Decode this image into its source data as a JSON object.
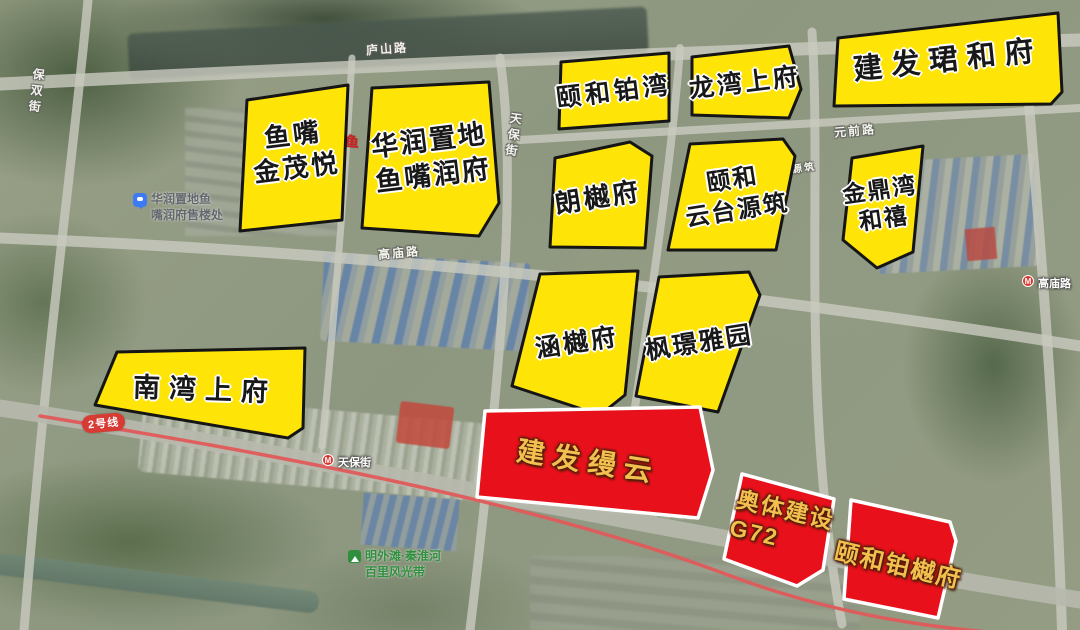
{
  "map": {
    "colors": {
      "plot_yellow": "#FFE408",
      "plot_red": "#E8101B",
      "plot_border": "#151515",
      "plot_border_red": "#FFFFFF",
      "gold_text": "#F3C04F",
      "metro_line2": "#E05A5A",
      "street_text": "#FAFAF2",
      "park_green": "#2F8F3F",
      "poi_gray": "#63676D",
      "pin_blue": "#3D7BF5",
      "fragment_red": "#CC2222"
    },
    "streets": [
      {
        "id": "baoshuang-st",
        "label": "保双街",
        "x": 28,
        "y": 68,
        "vertical": true,
        "rot": 7,
        "size": 12
      },
      {
        "id": "lushan-rd",
        "label": "庐山路",
        "x": 366,
        "y": 40,
        "vertical": false,
        "rot": -4,
        "size": 12
      },
      {
        "id": "yuanqian-rd",
        "label": "元前路",
        "x": 834,
        "y": 122,
        "vertical": false,
        "rot": -5,
        "size": 12
      },
      {
        "id": "tianbao-st-v",
        "label": "天保街",
        "x": 505,
        "y": 112,
        "vertical": true,
        "rot": 8,
        "size": 12
      },
      {
        "id": "gaomiao-rd",
        "label": "高庙路",
        "x": 378,
        "y": 244,
        "vertical": false,
        "rot": -5,
        "size": 12
      },
      {
        "id": "taiyuanzhu",
        "label": "台源筑",
        "x": 780,
        "y": 160,
        "vertical": false,
        "rot": -8,
        "size": 10
      }
    ],
    "pois": {
      "sales_office": {
        "lines": [
          "华润置地鱼",
          "嘴润府售楼处"
        ]
      },
      "park": {
        "lines": [
          "明外滩·秦淮河",
          "百里风光带"
        ]
      },
      "metro_tianbao": {
        "label": "天保街"
      },
      "metro_gaomiao": {
        "label": "高庙路"
      },
      "line2": {
        "label": "2号线"
      },
      "red_fragment": {
        "label": "国鱼"
      }
    },
    "plots": [
      {
        "id": "yuzui-jinmaoyue",
        "type": "yellow",
        "points": "247,100 348,85 342,220 240,231",
        "label_lines": [
          "鱼嘴",
          "金茂悦"
        ],
        "lx": 295,
        "ly": 152,
        "rot": -7,
        "size": 26,
        "ls": 3
      },
      {
        "id": "huarun-runfu",
        "type": "yellow",
        "points": "372,88 489,82 499,203 479,236 362,228",
        "label_lines": [
          "华润置地",
          "鱼嘴润府"
        ],
        "lx": 431,
        "ly": 158,
        "rot": -7,
        "size": 27,
        "ls": 2
      },
      {
        "id": "yihe-bowan",
        "type": "yellow",
        "points": "561,62 669,53 669,121 559,129",
        "label_lines": [
          "颐和铂湾"
        ],
        "lx": 614,
        "ly": 92,
        "rot": -7,
        "size": 25,
        "ls": 4
      },
      {
        "id": "longwan-shangfu",
        "type": "yellow",
        "points": "692,57 789,46 801,89 789,118 692,115",
        "label_lines": [
          "龙湾上府"
        ],
        "lx": 745,
        "ly": 83,
        "rot": -7,
        "size": 25,
        "ls": 3
      },
      {
        "id": "jianfa-junhefu",
        "type": "yellow",
        "points": "838,38 1058,13 1062,92 1051,104 834,106",
        "label_lines": [
          "建发珺和府"
        ],
        "lx": 948,
        "ly": 61,
        "rot": -6,
        "size": 29,
        "ls": 9
      },
      {
        "id": "langyuefu",
        "type": "yellow",
        "points": "555,158 630,142 652,156 645,248 550,247",
        "label_lines": [
          "朗樾府"
        ],
        "lx": 598,
        "ly": 198,
        "rot": -9,
        "size": 26,
        "ls": 3
      },
      {
        "id": "yihe-yuntaiyuanzhu",
        "type": "yellow",
        "points": "690,144 783,139 795,156 776,250 668,250",
        "label_lines": [
          "颐和",
          "云台源筑"
        ],
        "lx": 735,
        "ly": 196,
        "rot": -9,
        "size": 24,
        "ls": 2
      },
      {
        "id": "jindingwan-hexi",
        "type": "yellow",
        "points": "852,158 923,146 913,252 877,268 843,240",
        "label_lines": [
          "金鼎湾",
          "和禧"
        ],
        "lx": 882,
        "ly": 205,
        "rot": -8,
        "size": 23,
        "ls": 2
      },
      {
        "id": "hanyuefu",
        "type": "yellow",
        "points": "540,274 638,271 625,395 600,415 512,386",
        "label_lines": [
          "涵樾府"
        ],
        "lx": 577,
        "ly": 343,
        "rot": -9,
        "size": 25,
        "ls": 3
      },
      {
        "id": "fengjing-yayuan",
        "type": "yellow",
        "points": "659,277 749,272 760,295 718,412 636,396",
        "label_lines": [
          "枫璟雅园"
        ],
        "lx": 699,
        "ly": 343,
        "rot": -9,
        "size": 25,
        "ls": 2
      },
      {
        "id": "nanwan-shangfu",
        "type": "yellow",
        "points": "117,352 305,348 303,428 288,438 95,405",
        "label_lines": [
          "南湾上府"
        ],
        "lx": 205,
        "ly": 390,
        "rot": 2,
        "size": 27,
        "ls": 9
      },
      {
        "id": "jianfa-manyun",
        "type": "red",
        "points": "485,411 700,407 713,470 698,518 477,497",
        "label_lines": [
          "建发缦云"
        ],
        "lx": 588,
        "ly": 462,
        "rot": 9,
        "size": 28,
        "ls": 8
      },
      {
        "id": "aoti-g72",
        "type": "red",
        "points": "742,474 834,499 823,570 797,586 724,559",
        "label_lines": [
          "奥体建设",
          "G72"
        ],
        "lx": 782,
        "ly": 525,
        "rot": 13,
        "size": 23,
        "ls": 2,
        "align": "left"
      },
      {
        "id": "yihe-boyuefu",
        "type": "red",
        "points": "851,500 950,522 956,541 938,618 844,599",
        "label_lines": [
          "颐和铂樾府"
        ],
        "lx": 898,
        "ly": 567,
        "rot": 13,
        "size": 24,
        "ls": 2
      }
    ]
  }
}
